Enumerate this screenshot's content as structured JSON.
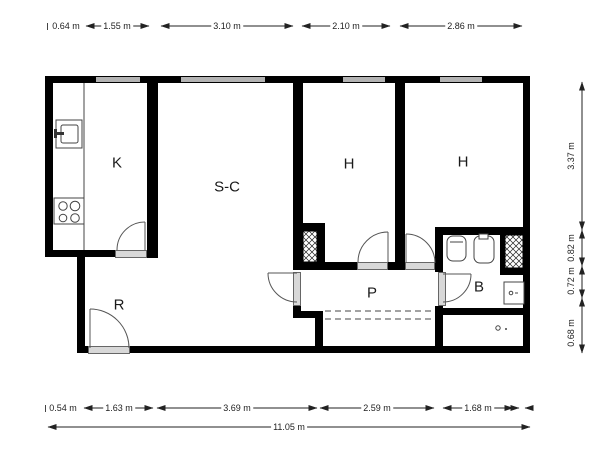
{
  "plan_type": "apartment floor plan",
  "rooms": [
    {
      "id": "kitchen",
      "label": "K"
    },
    {
      "id": "living-dining",
      "label": "S-C"
    },
    {
      "id": "bedroom-1",
      "label": "H"
    },
    {
      "id": "bedroom-2",
      "label": "H"
    },
    {
      "id": "entry-hall",
      "label": "R"
    },
    {
      "id": "hallway",
      "label": "P"
    },
    {
      "id": "bathroom",
      "label": "B"
    }
  ],
  "dimensions": {
    "top": [
      {
        "label": "0.64 m"
      },
      {
        "label": "1.55 m"
      },
      {
        "label": "3.10 m"
      },
      {
        "label": "2.10 m"
      },
      {
        "label": "2.86 m"
      }
    ],
    "bottom": [
      {
        "label": "0.54 m"
      },
      {
        "label": "1.63 m"
      },
      {
        "label": "3.69 m"
      },
      {
        "label": "2.59 m"
      },
      {
        "label": "1.68 m"
      }
    ],
    "overall_width": {
      "label": "11.05 m"
    },
    "right": [
      {
        "label": "3.37 m"
      },
      {
        "label": "0.82 m"
      },
      {
        "label": "0.72 m"
      },
      {
        "label": "0.68 m"
      }
    ]
  },
  "colors": {
    "wall": "#000000",
    "window_fill": "#b3b3b3",
    "door_sill": "#d8d8d8",
    "line": "#333333"
  }
}
